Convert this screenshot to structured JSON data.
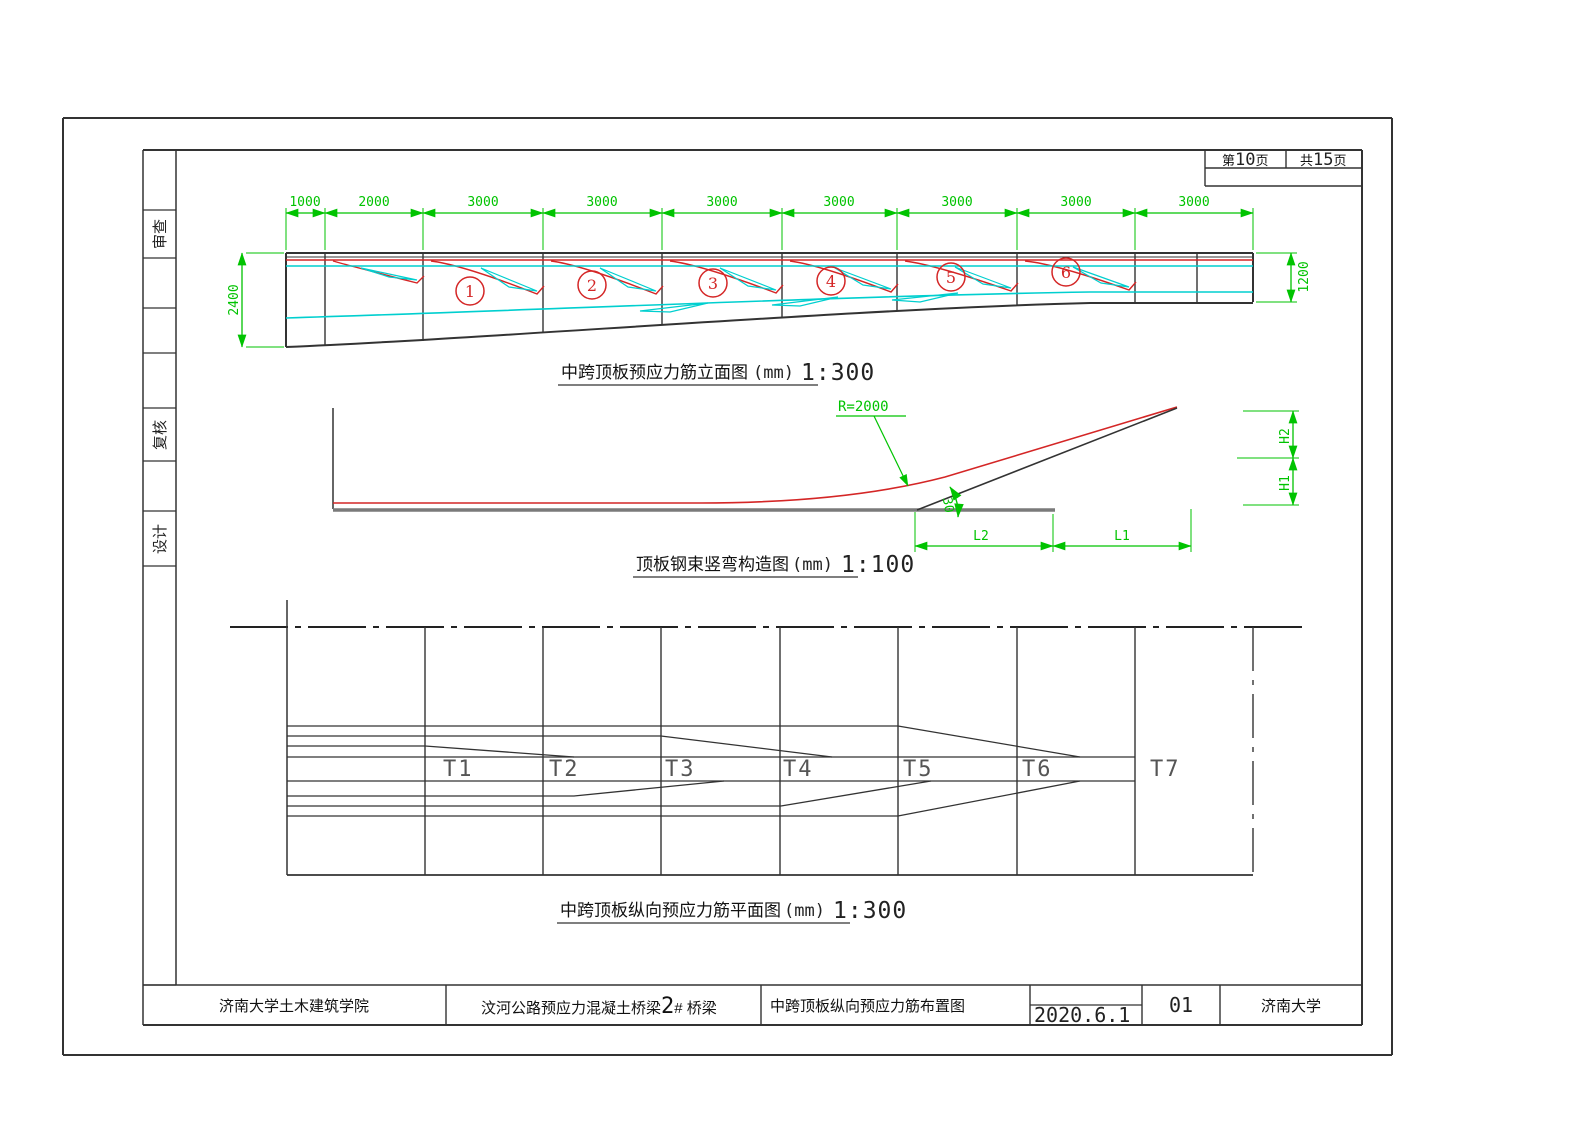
{
  "sheet_info": {
    "page": {
      "prefix": "第",
      "num": "10",
      "suffix": "页"
    },
    "total": {
      "prefix": "共",
      "num": "15",
      "suffix": "页"
    }
  },
  "side_labels": [
    "审查",
    "复核",
    "设计"
  ],
  "drawing1": {
    "caption": {
      "cn": "中跨顶板预应力筋立面图",
      "unit": "(mm)",
      "scale": "1:300"
    },
    "dims_top": [
      "1000",
      "2000",
      "3000",
      "3000",
      "3000",
      "3000",
      "3000",
      "3000",
      "3000"
    ],
    "dim_left": "2400",
    "dim_right": "1200",
    "tendon_numbers": [
      "1",
      "2",
      "3",
      "4",
      "5",
      "6"
    ]
  },
  "drawing2": {
    "caption": {
      "cn": "顶板钢束竖弯构造图",
      "unit": "(mm)",
      "scale": "1:100"
    },
    "radius_label": "R=2000",
    "angle_label": "30",
    "dims": {
      "h1": "H1",
      "h2": "H2",
      "l1": "L1",
      "l2": "L2"
    }
  },
  "drawing3": {
    "caption": {
      "cn": "中跨顶板纵向预应力筋平面图",
      "unit": "(mm)",
      "scale": "1:300"
    },
    "tendon_labels": [
      "T1",
      "T2",
      "T3",
      "T4",
      "T5",
      "T6",
      "T7"
    ]
  },
  "title_block": {
    "organization": "济南大学土木建筑学院",
    "project": "汶河公路预应力混凝土桥梁",
    "project_no": "2",
    "project_suffix": "# 桥梁",
    "drawing_title": "中跨顶板纵向预应力筋布置图",
    "date": "2020.6.1",
    "sheet_no": "01",
    "university": "济南大学"
  },
  "colors": {
    "dim_green": "#00c300",
    "tendon_red": "#d42626",
    "tendon_cyan": "#00cfcf"
  }
}
